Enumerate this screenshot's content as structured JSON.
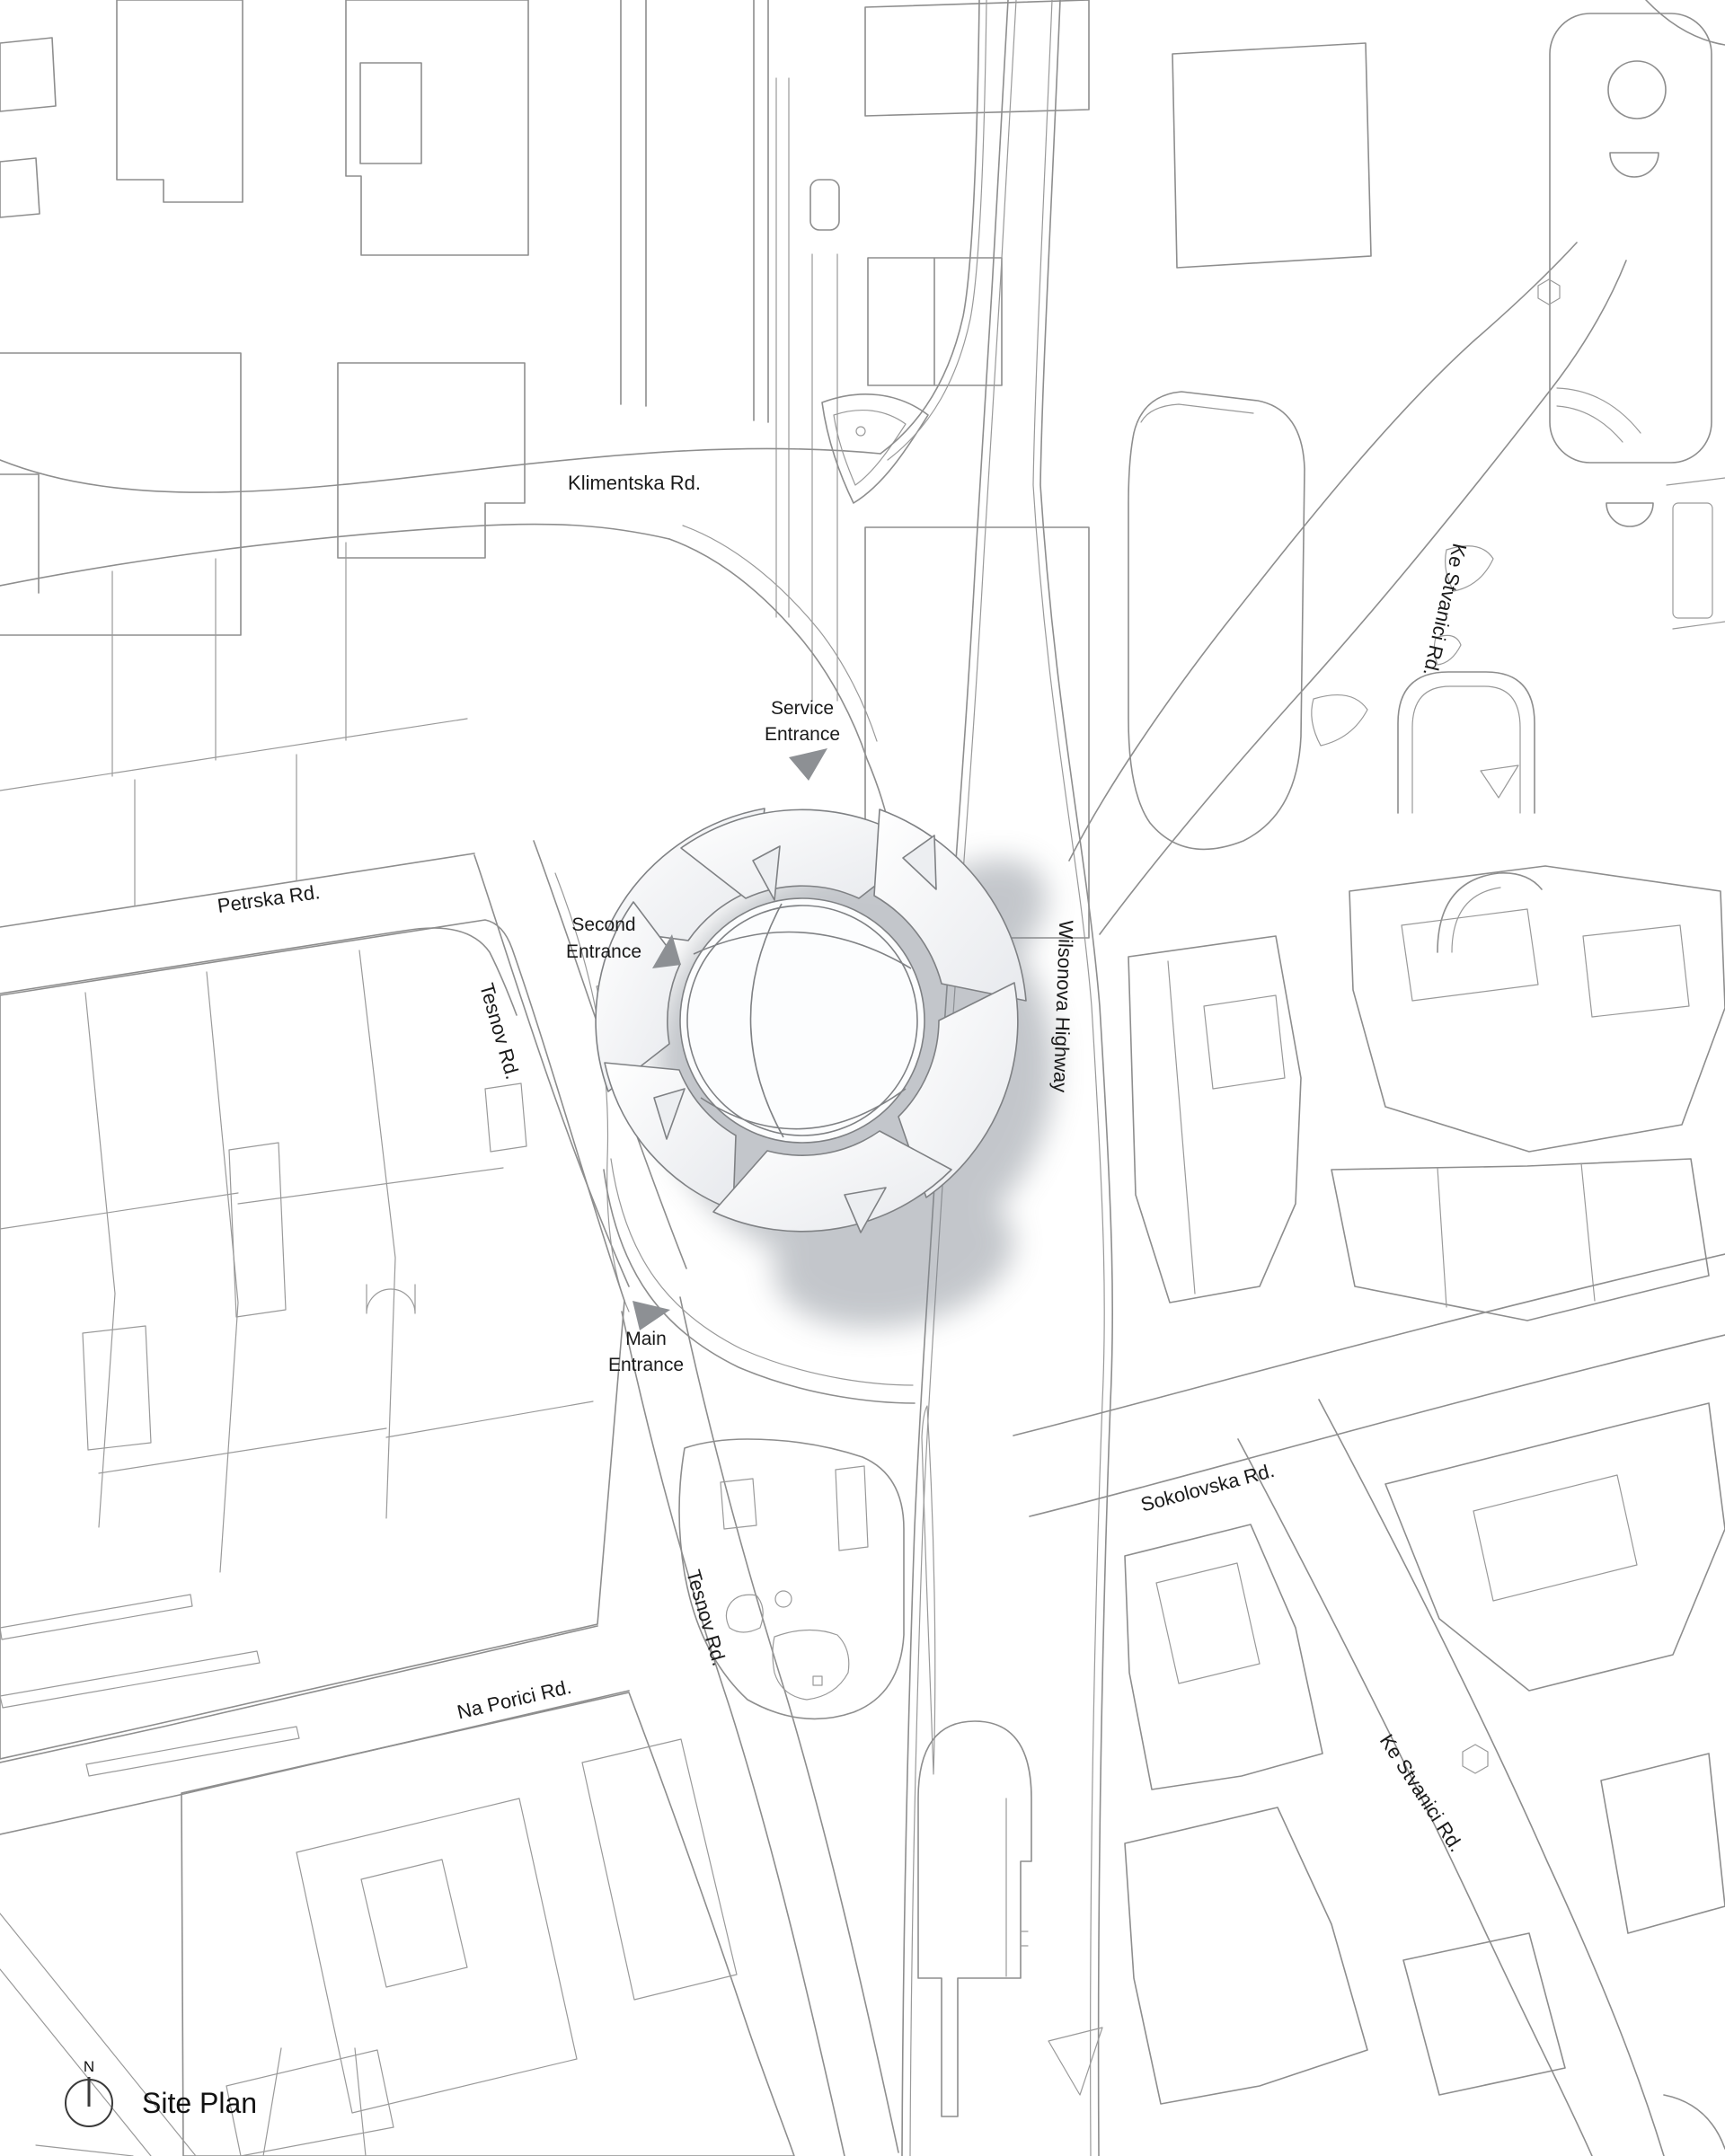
{
  "page": {
    "title": "Site Plan"
  },
  "compass": {
    "north": "N"
  },
  "colors": {
    "background": "#ffffff",
    "linework": "#8e8e8e",
    "label_text": "#1a1a1a",
    "entrance_marker": "#8d9094",
    "building_shadow": "#7c838d"
  },
  "streets": {
    "klimentska": "Klimentska Rd.",
    "ke_stvanici_top": "Ke Stvanici Rd.",
    "petrska": "Petrska Rd.",
    "tesnov_upper": "Tesnov Rd.",
    "wilsonova": "Wilsonova Highway",
    "sokolovska": "Sokolovska Rd.",
    "tesnov_lower": "Tesnov Rd.",
    "na_porici": "Na Porici Rd.",
    "ke_stvanici_bottom": "Ke Stvanici Rd."
  },
  "entrances": {
    "service": {
      "line1": "Service",
      "line2": "Entrance"
    },
    "second": {
      "line1": "Second",
      "line2": "Entrance"
    },
    "main": {
      "line1": "Main",
      "line2": "Entrance"
    }
  }
}
